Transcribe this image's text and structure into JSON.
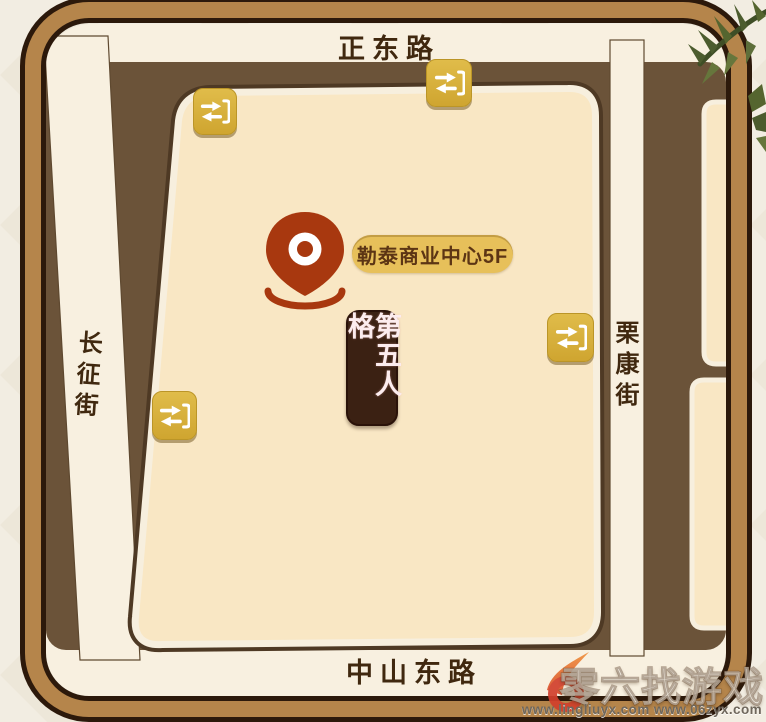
{
  "map": {
    "road_labels": {
      "top": "正东路",
      "bottom": "中山东路",
      "left": "长征街",
      "right": "栗康街"
    },
    "poi": {
      "label": "勒泰商业中心5F"
    },
    "banner": {
      "text": "第五人格"
    }
  },
  "watermark": {
    "brand": "零六找游戏",
    "urls": "www.lingliuyx.com  www.06zyx.com"
  },
  "colors": {
    "frame_border": "#b5854b",
    "frame_outline": "#2c190b",
    "road": "#f8f0e0",
    "city_block": "#6b5339",
    "venue_block": "#f9e7c4",
    "station_gold": "#d9b340",
    "pin_red": "#a8380f",
    "poi_pill": "#e7c05a",
    "banner_bg": "#3b2113",
    "label_ink": "#40280f"
  }
}
